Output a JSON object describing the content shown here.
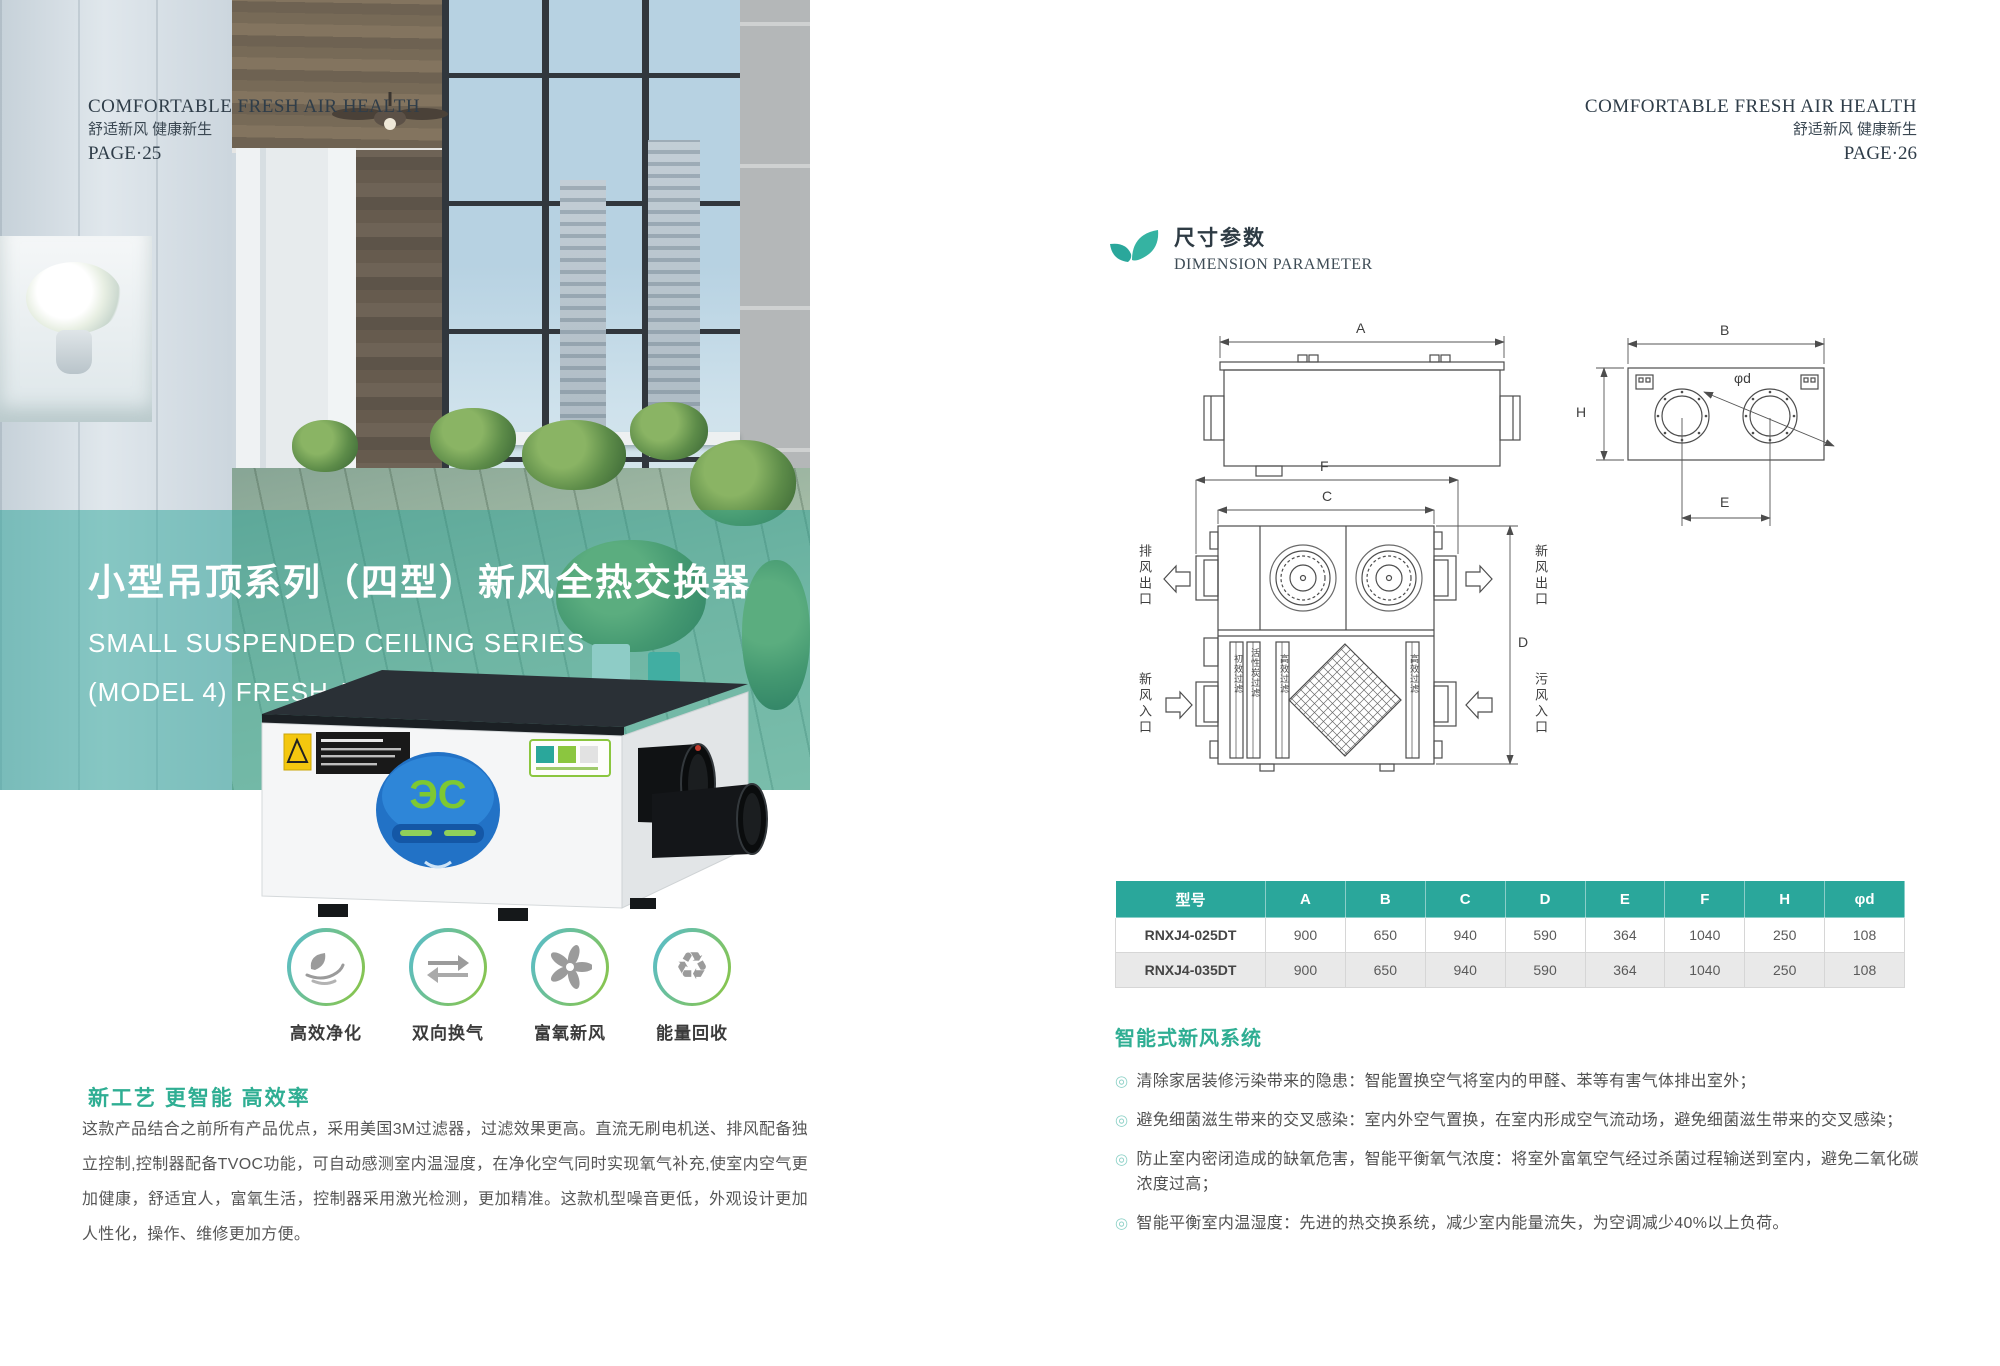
{
  "colors": {
    "accent": "#2aa79b",
    "heading_green": "#2fae93",
    "header_text": "#2f3d49"
  },
  "icons": {
    "bullet": "◎",
    "recycle": "♻"
  },
  "left": {
    "header": {
      "en": "COMFORTABLE FRESH AIR HEALTH",
      "cn": "舒适新风  健康新生",
      "page": "PAGE·25"
    },
    "hero": {
      "cn": "小型吊顶系列（四型）新风全热交换器",
      "en1": "SMALL SUSPENDED CEILING SERIES",
      "en2": "(MODEL 4) FRESH AIR HEAT EXCHANGER"
    },
    "features": [
      {
        "label": "高效净化"
      },
      {
        "label": "双向换气"
      },
      {
        "label": "富氧新风"
      },
      {
        "label": "能量回收"
      }
    ],
    "intro": {
      "heading": "新工艺  更智能  高效率",
      "body": "这款产品结合之前所有产品优点，采用美国3M过滤器，过滤效果更高。直流无刷电机送、排风配备独立控制,控制器配备TVOC功能，可自动感测室内温湿度，在净化空气同时实现氧气补充,使室内空气更加健康，舒适宜人，富氧生活，控制器采用激光检测，更加精准。这款机型噪音更低，外观设计更加人性化，操作、维修更加方便。"
    }
  },
  "right": {
    "header": {
      "en": "COMFORTABLE FRESH AIR HEALTH",
      "cn": "舒适新风  健康新生",
      "page": "PAGE·26"
    },
    "section": {
      "cn": "尺寸参数",
      "en": "DIMENSION PARAMETER"
    },
    "drawing": {
      "dim_a": "A",
      "dim_b": "B",
      "dim_c": "C",
      "dim_d": "D",
      "dim_e": "E",
      "dim_f": "F",
      "dim_h": "H",
      "dim_phi": "φd",
      "exhaust_out": "排风出口",
      "fresh_in": "新风入口",
      "fresh_out": "新风出口",
      "foul_in": "污风入口",
      "filter_primary": "初效过滤",
      "filter_carbon": "活性炭过滤",
      "filter_hepa_1": "高效过滤",
      "filter_hepa_2": "高效过滤"
    },
    "table": {
      "headers": [
        "型号",
        "A",
        "B",
        "C",
        "D",
        "E",
        "F",
        "H",
        "φd"
      ],
      "rows": [
        {
          "model": "RNXJ4-025DT",
          "values": [
            "900",
            "650",
            "940",
            "590",
            "364",
            "1040",
            "250",
            "108"
          ]
        },
        {
          "model": "RNXJ4-035DT",
          "values": [
            "900",
            "650",
            "940",
            "590",
            "364",
            "1040",
            "250",
            "108"
          ]
        }
      ]
    },
    "smart": {
      "heading": "智能式新风系统",
      "bullets": [
        "清除家居装修污染带来的隐患：智能置换空气将室内的甲醛、苯等有害气体排出室外；",
        "避免细菌滋生带来的交叉感染：室内外空气置换，在室内形成空气流动场，避免细菌滋生带来的交叉感染；",
        "防止室内密闭造成的缺氧危害，智能平衡氧气浓度：将室外富氧空气经过杀菌过程输送到室内，避免二氧化碳浓度过高；",
        "智能平衡室内温湿度：先进的热交换系统，减少室内能量流失，为空调减少40%以上负荷。"
      ]
    }
  }
}
